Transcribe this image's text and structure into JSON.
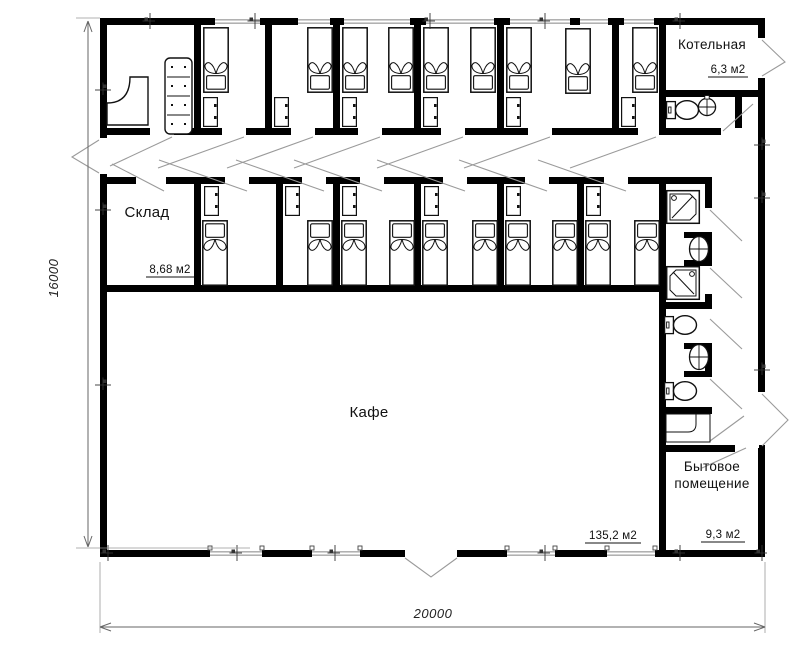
{
  "plan": {
    "rooms": {
      "boiler": {
        "label": "Котельная",
        "area": "6,3 м2"
      },
      "storage": {
        "label": "Склад",
        "area": "8,68 м2"
      },
      "cafe": {
        "label": "Кафе",
        "area": "135,2 м2"
      },
      "utility": {
        "label_line1": "Бытовое",
        "label_line2": "помещение",
        "area": "9,3 м2"
      }
    },
    "dimensions": {
      "overall_length": "20000",
      "overall_depth": "16000"
    },
    "colors": {
      "wall": "#000000",
      "furniture_line": "#111111",
      "door_swing": "#9a9a9a",
      "window_line": "#a6a6a6",
      "dimension_line": "#666666"
    }
  }
}
